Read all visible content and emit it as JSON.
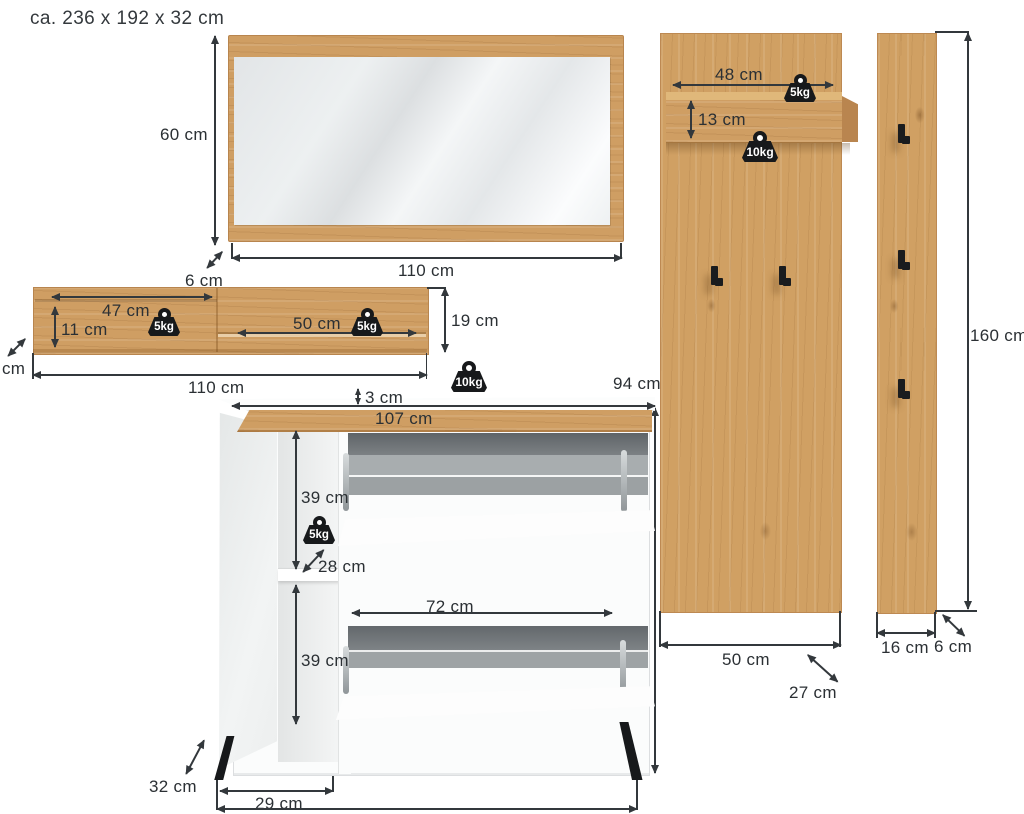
{
  "title": "ca. 236 x 192 x 32 cm",
  "colors": {
    "wood": "#cf9e63",
    "line": "#33383c",
    "text": "#2b3034",
    "weight_badge": "#17191b"
  },
  "mirror": {
    "height": "60 cm",
    "width": "110 cm",
    "depth": "6 cm"
  },
  "wall_shelf": {
    "left_section_width": "47 cm",
    "left_section_height": "11 cm",
    "left_load": "5kg",
    "right_section_width": "50 cm",
    "right_load": "5kg",
    "height": "19 cm",
    "width": "110 cm",
    "depth_unit_clipped": "cm"
  },
  "shoe_cabinet": {
    "top_thickness": "3 cm",
    "inner_width": "107 cm",
    "top_load": "10kg",
    "height": "94 cm",
    "upper_compartment_height": "39 cm",
    "middle_load": "5kg",
    "shelf_depth": "28 cm",
    "flap_width": "72 cm",
    "lower_compartment_height": "39 cm",
    "depth": "32 cm",
    "door_width": "29 cm"
  },
  "wide_panel": {
    "shelf_width": "48 cm",
    "shelf_load_top": "5kg",
    "shelf_height": "13 cm",
    "shelf_load_bottom": "10kg",
    "width": "50 cm",
    "depth": "27 cm"
  },
  "narrow_panel": {
    "height": "160 cm",
    "width": "16 cm",
    "depth": "6 cm"
  }
}
